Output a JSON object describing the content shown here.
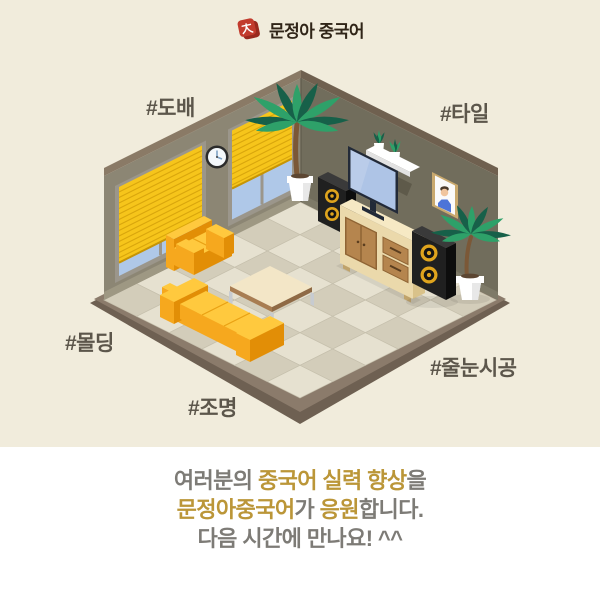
{
  "header": {
    "brand": "문정아 중국어"
  },
  "hashtags": [
    {
      "label": "#도배"
    },
    {
      "label": "#타일"
    },
    {
      "label": "#몰딩"
    },
    {
      "label": "#조명"
    },
    {
      "label": "#줄눈시공"
    }
  ],
  "footer": {
    "line1": {
      "seg1": "여러분의 ",
      "seg2": "중국어 실력 향상",
      "seg3": "을"
    },
    "line2": {
      "seg1": "문정아중국어",
      "seg2": "가 ",
      "seg3": "응원",
      "seg4": "합니다."
    },
    "line3": "다음 시간에 만나요! ^^"
  },
  "illustration": {
    "scene": "isometric-living-room",
    "objects": [
      "tiled-floor",
      "left-wall-with-windows",
      "yellow-window-blinds",
      "wall-clock",
      "right-wall",
      "wall-shelf-with-plants",
      "picture-frame",
      "corner-palm-plant",
      "tv",
      "tv-cabinet",
      "speaker-left",
      "speaker-right",
      "potted-palm-plant",
      "yellow-loveseat",
      "coffee-table",
      "yellow-sofa"
    ]
  },
  "colors": {
    "background": "#F1ECDC",
    "panel": "#FFFFFF",
    "logo_red": "#C23B2D",
    "logo_red_dark": "#99291E",
    "brand_text": "#302518",
    "hashtag_text": "#5C564B",
    "footer_gray": "#7D7B76",
    "footer_gold": "#BB9638",
    "wall_left": "#8C8674",
    "wall_right": "#716D5C",
    "trim_left": "#8A7A66",
    "trim_right": "#6F604F",
    "baseboard_left": "#9E9883",
    "baseboard_right": "#7E7A68",
    "tile_light": "#E6E1D0",
    "tile_dark": "#D3CDBA",
    "tile_edge": "#C6C0AD",
    "slab_top": "#8B7B6B",
    "slab_side": "#6E6052",
    "window_frame": "#9B968B",
    "glass": "#AFC8E8",
    "blind": "#F6C51B",
    "blind_stripe": "#D9A60D",
    "blind_bottom": "#C69405",
    "sofa_top": "#FFC93E",
    "sofa_light": "#F6A81E",
    "sofa_dark": "#E28E06",
    "sofa_seam": "#E9A013",
    "wood_top": "#F6E9C4",
    "wood_front": "#EBD9AB",
    "wood_side": "#D9C28A",
    "wood_leg": "#C0A36B",
    "panel_wood": "#B5854E",
    "panel_line": "#8F6434",
    "knob": "#5B3E1F",
    "table_top": "#F3E6C7",
    "table_edge": "#A87D52",
    "table_edge_dark": "#8F6A45",
    "leg_metal": "#C7CBD0",
    "speaker_top": "#3A3A3A",
    "speaker_front": "#202020",
    "speaker_side": "#0D0D0D",
    "speaker_ring": "#DFA41D",
    "tv_bezel": "#222A38",
    "tv_screen": "#AEC4E6",
    "leaf_dark": "#176049",
    "leaf_light": "#2EA169",
    "trunk": "#7B5837",
    "pot": "#FFFFFF",
    "pot_shade": "#E8E8E8",
    "soil": "#5C4632",
    "clock_rim": "#2B2B2B",
    "clock_face": "#F4F8FB",
    "clock_hand": "#7FA3C6",
    "photo_frame": "#C9A96E",
    "photo_blue": "#4D74D8",
    "skin": "#F0C59E",
    "hair": "#4A3A2C",
    "corner_line": "#5F5B4D"
  }
}
